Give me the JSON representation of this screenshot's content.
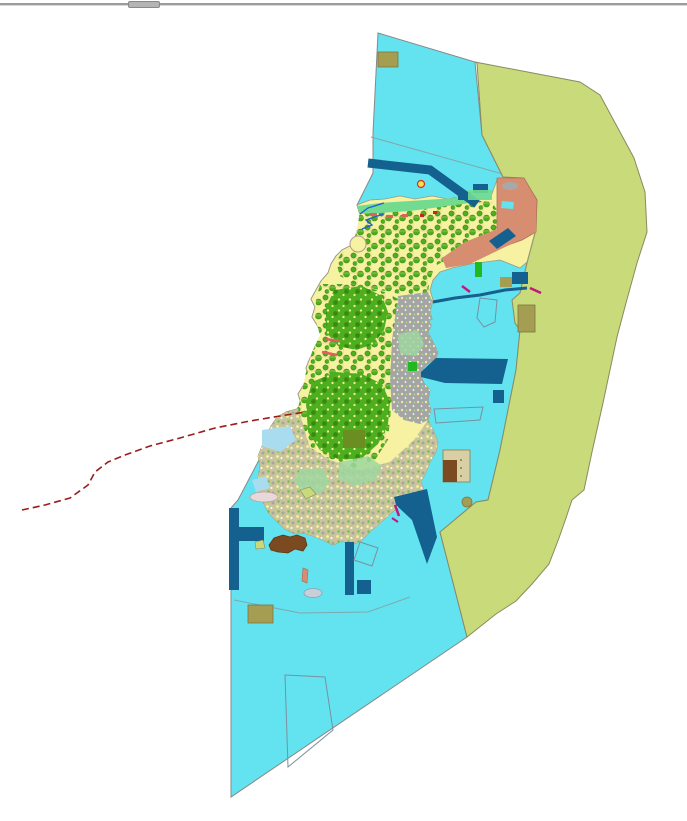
{
  "window": {
    "splitter": "divider-handle"
  },
  "map": {
    "kind": "gis-land-use-zoning-map",
    "colors": {
      "water": "#63E3F0",
      "shallow_water": "#A9DCEF",
      "offshore_zone": "#C8DA79",
      "offshore_stroke": "#8a8a60",
      "island_base": "#F7F1A2",
      "island_stroke": "#9a9a80",
      "forest_green": "#4DAF1E",
      "forest_dark": "#3A8A12",
      "urban_gray": "#A5A5A5",
      "mixed_tan": "#C9C49A",
      "pale_green": "#9FD7A0",
      "coastal_greenbelt": "#72DB90",
      "salmon_zone": "#D78E70",
      "harbor_blue": "#14608F",
      "khaki_parcel": "#A59D52",
      "tan_parcel": "#D9CFA4",
      "brown_port": "#7C4A20",
      "olive_field": "#6B8E23",
      "bright_green": "#22B822",
      "red_boundary": "#9B1C1C",
      "river_blue": "#2060D8",
      "salmon_mark": "#E06060",
      "magenta_mark": "#C0187B",
      "red_mark": "#CC2222",
      "sandbank_pink": "#E8D8D8",
      "sandbank_gray": "#C8CFD8",
      "gray_blob": "#A8A8A8",
      "water_stroke": "#888888"
    },
    "zones": [
      {
        "id": "coastal-water-zone",
        "color": "#63E3F0"
      },
      {
        "id": "offshore-buffer-zone",
        "color": "#C8DA79"
      },
      {
        "id": "island-land",
        "color": "#F7F1A2"
      },
      {
        "id": "forest-area",
        "color": "#4DAF1E"
      },
      {
        "id": "urban-area",
        "color": "#A5A5A5"
      },
      {
        "id": "coastal-greenbelt",
        "color": "#72DB90"
      },
      {
        "id": "resort-zone",
        "color": "#D78E70"
      },
      {
        "id": "harbor-facility",
        "color": "#14608F"
      },
      {
        "id": "khaki-parcel",
        "color": "#A59D52"
      },
      {
        "id": "port-industrial-area",
        "color": "#7C4A20"
      },
      {
        "id": "restricted-boundary-line",
        "color": "#9B1C1C"
      }
    ]
  }
}
